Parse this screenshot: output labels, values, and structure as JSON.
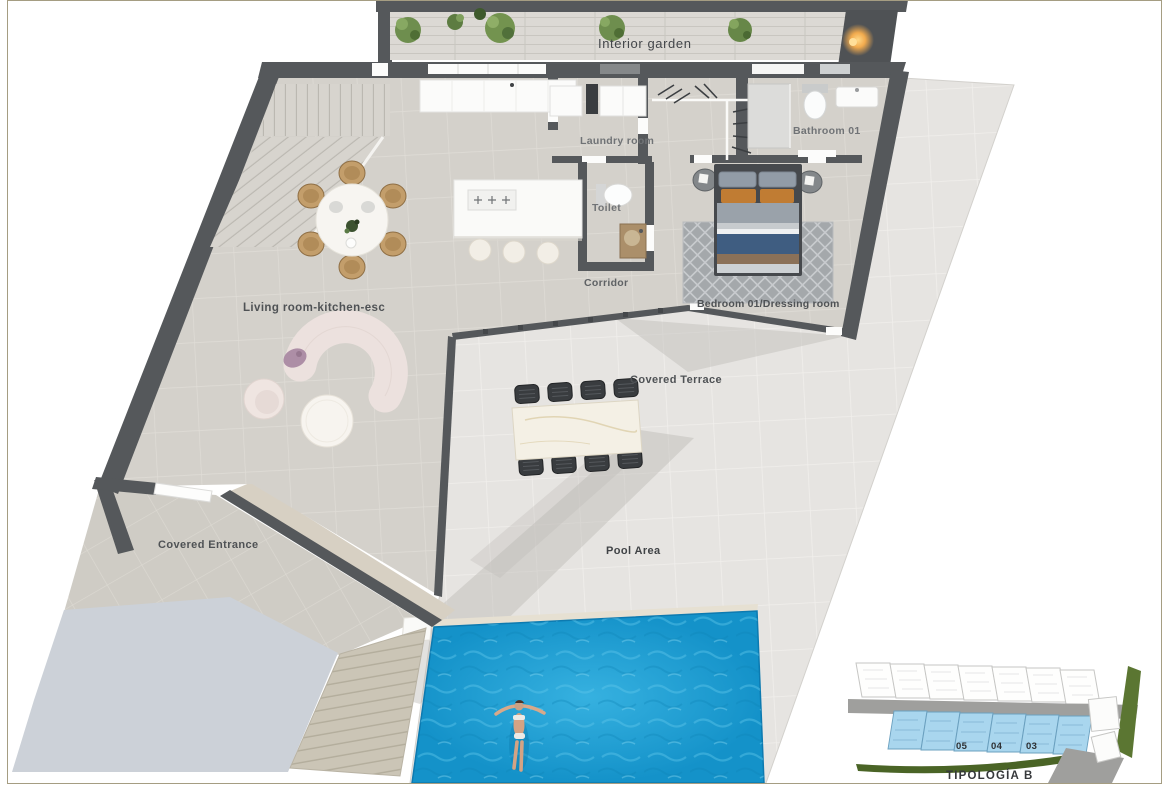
{
  "labels": {
    "interior_garden": "Interior garden",
    "laundry_room": "Laundry room",
    "bathroom_01": "Bathroom 01",
    "toilet": "Toilet",
    "corridor": "Corridor",
    "bedroom_01_dressing": "Bedroom 01/Dressing room",
    "living_room_kitchen": "Living room-kitchen-esc",
    "covered_terrace": "Covered Terrace",
    "pool_area": "Pool Area",
    "covered_entrance": "Covered Entrance"
  },
  "site_plan_inset": {
    "title": "TIPOLOGÍA B",
    "unit_numbers": [
      "05",
      "04",
      "03"
    ],
    "highlighted_units_color": "#a9d6ee"
  },
  "colors": {
    "wall": "#55585b",
    "interior_floor": "#d4d1cb",
    "exterior_tile": "#e6e4e1",
    "pool_water": "#1a9ad2",
    "driveway": "#ccd1d8",
    "garden_wood": "#dcd9d4",
    "plant_green": "#6f8f4f",
    "page_border": "#a59d82",
    "warm_light": "#f2ab4e",
    "site_road": "#9f9f9d",
    "site_green": "#4a6426"
  }
}
